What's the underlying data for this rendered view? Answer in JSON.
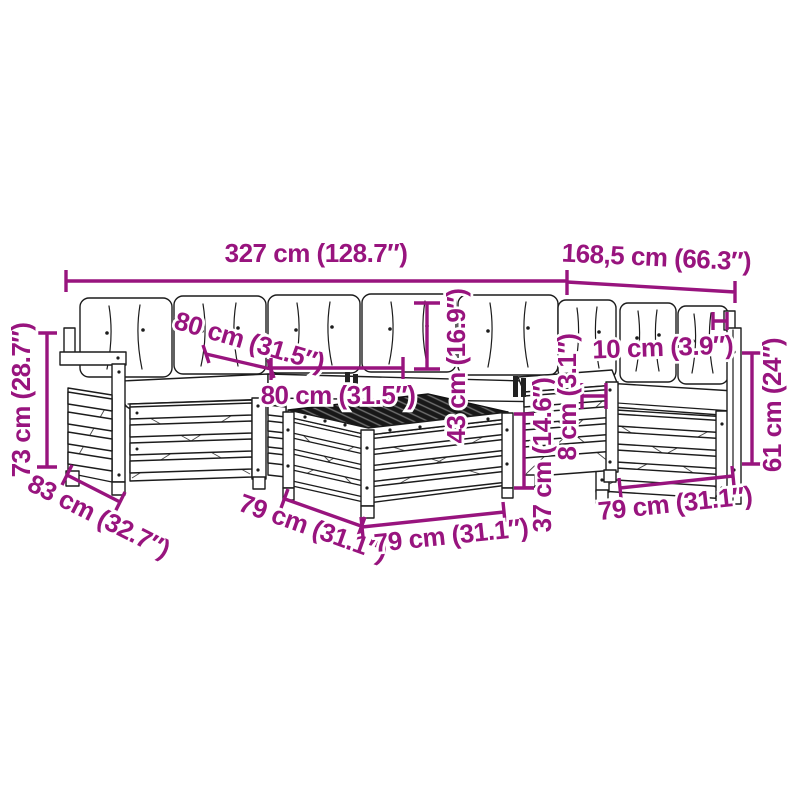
{
  "diagram": {
    "subject": "Modular wooden garden sofa set with cushions and square slatted table — technical line drawing with dimension callouts",
    "colors": {
      "dimension": "#98147E",
      "line_art": "#1c1c1c",
      "background": "#ffffff"
    },
    "dims": [
      {
        "id": "total-width-left",
        "label": "327 cm (128.7″)"
      },
      {
        "id": "total-width-right",
        "label": "168,5 cm (66.3″)"
      },
      {
        "id": "seat-depth",
        "label": "80 cm (31.5″)"
      },
      {
        "id": "seat-module-width",
        "label": "80 cm (31.5″)"
      },
      {
        "id": "back-cushion-height",
        "label": "43 cm (16.9″)"
      },
      {
        "id": "overall-height",
        "label": "73 cm (28.7″)"
      },
      {
        "id": "corner-module-depth",
        "label": "83 cm (32.7″)"
      },
      {
        "id": "table-depth",
        "label": "79 cm (31.1″)"
      },
      {
        "id": "table-width",
        "label": "79 cm (31.1″)"
      },
      {
        "id": "table-height",
        "label": "37 cm (14.6″)"
      },
      {
        "id": "connector-thickness",
        "label": "8 cm (3.1″)"
      },
      {
        "id": "armrest-width",
        "label": "10 cm (3.9″)"
      },
      {
        "id": "side-height",
        "label": "61 cm (24″)"
      },
      {
        "id": "right-module-width",
        "label": "79 cm (31.1″)"
      }
    ]
  }
}
